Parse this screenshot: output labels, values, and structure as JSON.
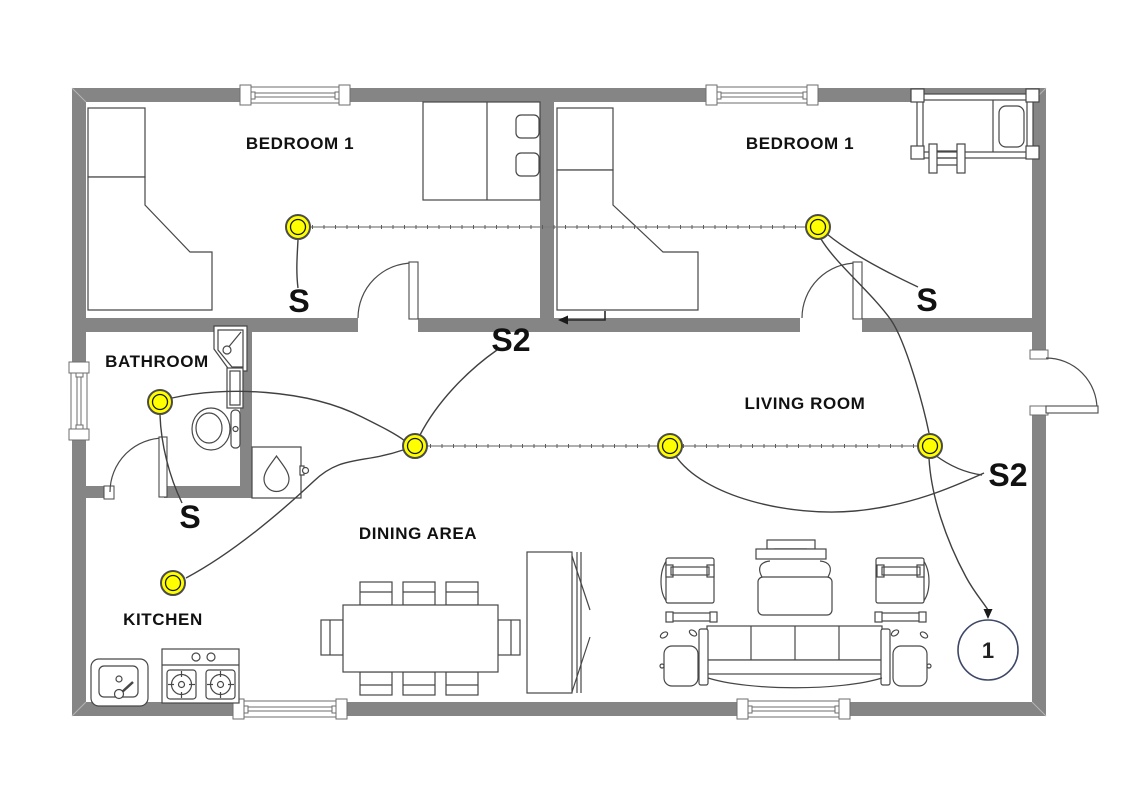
{
  "floor_plan": {
    "title": "two-bedroom house electrical lighting plan",
    "rooms": [
      {
        "id": "bedroom-left",
        "label": "BEDROOM 1"
      },
      {
        "id": "bedroom-right",
        "label": "BEDROOM 1"
      },
      {
        "id": "bathroom",
        "label": "BATHROOM"
      },
      {
        "id": "living-room",
        "label": "LIVING ROOM"
      },
      {
        "id": "dining-area",
        "label": "DINING AREA"
      },
      {
        "id": "kitchen",
        "label": "KITCHEN"
      }
    ],
    "switches": [
      {
        "id": "switch-bedroom-left",
        "label": "S"
      },
      {
        "id": "switch-bedroom-right",
        "label": "S"
      },
      {
        "id": "switch-bathroom",
        "label": "S"
      },
      {
        "id": "switch-two-way-hall",
        "label": "S2"
      },
      {
        "id": "switch-two-way-living",
        "label": "S2"
      }
    ],
    "home_run_circuit": {
      "label": "1"
    },
    "lights_count": 7,
    "icons": [
      "ceiling-light-icon",
      "home-run-circle",
      "arrow-icon",
      "bed-icon",
      "crib-icon",
      "wardrobe-icon",
      "toilet-icon",
      "shower-icon",
      "water-heater-icon",
      "sink-icon",
      "stove-icon",
      "dining-set-icon",
      "sofa-icon",
      "armchair-icon",
      "tv-console-icon",
      "door-icon",
      "window-icon"
    ],
    "colors": {
      "wall": "#858585",
      "light_fill": "#FFFF00",
      "wire": "#404040",
      "cable_gray": "#7F7F7F",
      "circuit_circle": "#3D4766",
      "text": "#111111"
    }
  }
}
